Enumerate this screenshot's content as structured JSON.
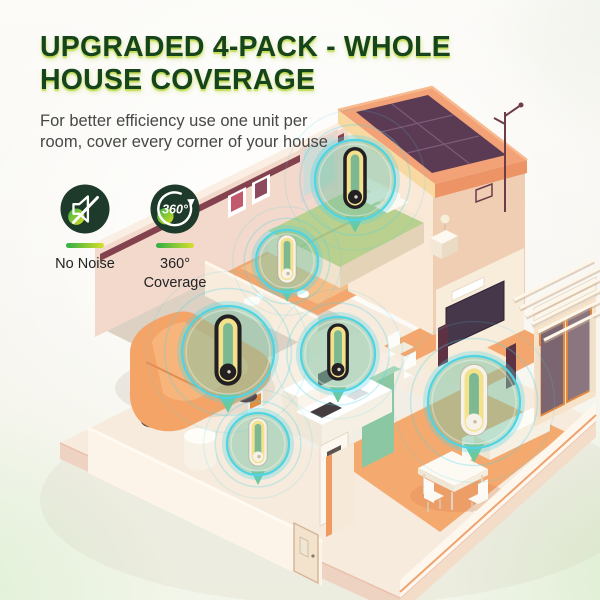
{
  "page": {
    "width": 600,
    "height": 600
  },
  "header": {
    "title_line1": "UPGRADED 4-PACK - WHOLE",
    "title_line2": "HOUSE COVERAGE",
    "subtitle_line1": "For better efficiency use one unit per",
    "subtitle_line2": "room, cover every corner of your house"
  },
  "features": {
    "no_noise": {
      "label": "No Noise"
    },
    "coverage": {
      "badge": "360°",
      "label_line1": "360°",
      "label_line2": "Coverage"
    }
  },
  "illustration": {
    "device_bubbles": [
      {
        "id": "bedroom",
        "x": 355,
        "y": 180,
        "r": 40,
        "variant": "dark"
      },
      {
        "id": "hallway",
        "x": 287,
        "y": 261,
        "r": 31,
        "variant": "white"
      },
      {
        "id": "garage",
        "x": 228,
        "y": 352,
        "r": 46,
        "variant": "dark"
      },
      {
        "id": "kitchen",
        "x": 338,
        "y": 354,
        "r": 37,
        "variant": "dark"
      },
      {
        "id": "laundry",
        "x": 258,
        "y": 444,
        "r": 31,
        "variant": "white"
      },
      {
        "id": "living-room",
        "x": 474,
        "y": 402,
        "r": 46,
        "variant": "white"
      }
    ]
  },
  "colors": {
    "title_green": "#15441d",
    "title_glow": "#b8d63c",
    "subtitle_gray": "#474746",
    "icon_circle_green": "#1e3a2a",
    "accent_green": "#35b14b",
    "accent_yellow": "#d9e021",
    "bubble_rim_cyan": "#4fd4e4",
    "bubble_fill_green": "rgba(126,196,165,0.5)",
    "pin_green": "#6cc89d",
    "device_dark": "#232024",
    "device_white": "#f6f2e8",
    "device_ring_yellow": "#f3e18c",
    "device_slot_green": "rgba(117,182,148,0.95)"
  }
}
